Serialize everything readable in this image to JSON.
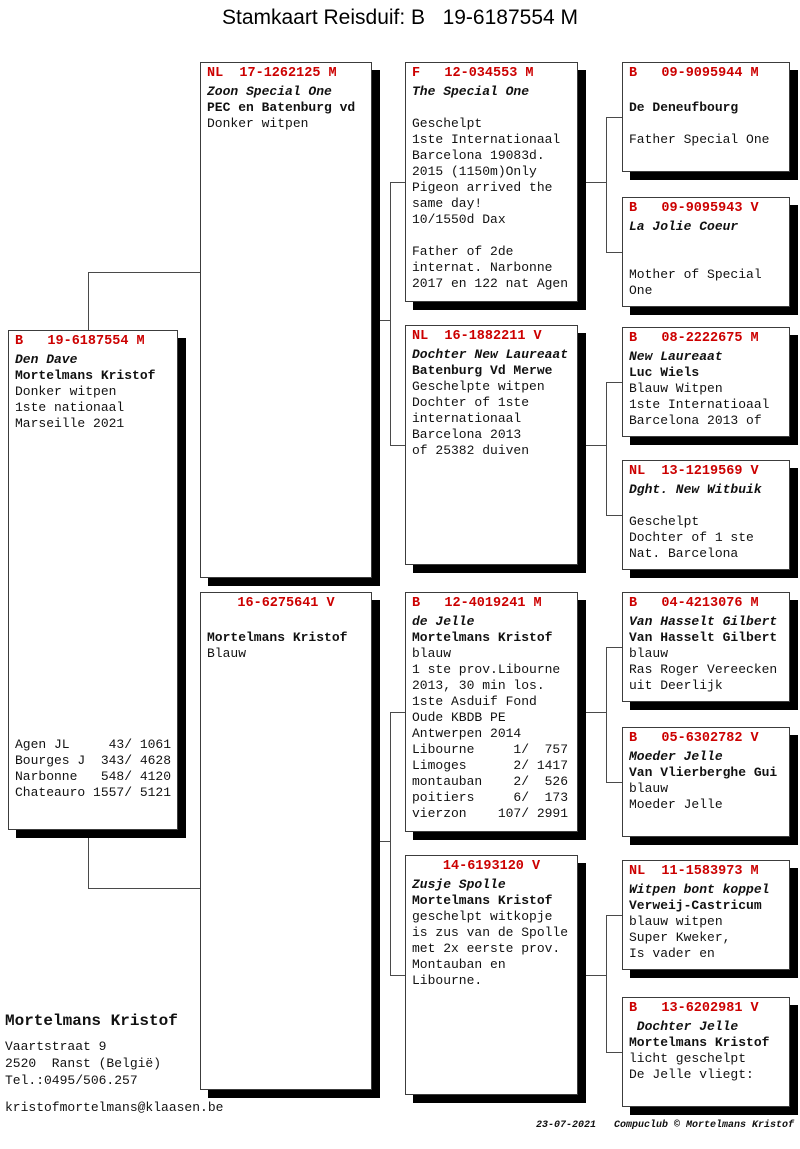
{
  "title": "Stamkaart Reisduif: B   19-6187554 M",
  "colors": {
    "header_red": "#cc0000",
    "shadow": "#000000"
  },
  "boxes": {
    "subject": {
      "header": "B   19-6187554 M",
      "lines": [
        "Den Dave",
        "Mortelmans Kristof",
        "Donker witpen",
        "1ste nationaal",
        "Marseille 2021"
      ],
      "results": [
        "Agen JL     43/ 1061",
        "Bourges J  343/ 4628",
        "Narbonne   548/ 4120",
        "Chateauro 1557/ 5121"
      ]
    },
    "sire": {
      "header": "NL  17-1262125 M",
      "lines": [
        "Zoon Special One",
        "PEC en Batenburg vd",
        "Donker witpen"
      ]
    },
    "dam": {
      "header": "16-6275641 V",
      "lines": [
        "",
        "Mortelmans Kristof",
        "Blauw"
      ]
    },
    "sire_sire": {
      "header": "F   12-034553 M",
      "lines": [
        "The Special One",
        "",
        "Geschelpt",
        "1ste Internationaal",
        "Barcelona 19083d.",
        "2015 (1150m)Only",
        "Pigeon arrived the",
        "same day!",
        "10/1550d Dax",
        "",
        "Father of 2de",
        "internat. Narbonne",
        "2017 en 122 nat Agen"
      ]
    },
    "sire_dam": {
      "header": "NL  16-1882211 V",
      "lines": [
        "Dochter New Laureaat",
        "Batenburg Vd Merwe",
        "Geschelpte witpen",
        "Dochter of 1ste",
        "internationaal",
        "Barcelona 2013",
        "of 25382 duiven"
      ]
    },
    "dam_sire": {
      "header": "B   12-4019241 M",
      "lines": [
        "de Jelle",
        "Mortelmans Kristof",
        "blauw",
        "1 ste prov.Libourne",
        "2013, 30 min los.",
        "1ste Asduif Fond",
        "Oude KBDB PE",
        "Antwerpen 2014",
        "Libourne     1/  757",
        "Limoges      2/ 1417",
        "montauban    2/  526",
        "poitiers     6/  173",
        "vierzon    107/ 2991"
      ]
    },
    "dam_dam": {
      "header": "14-6193120 V",
      "lines": [
        "Zusje Spolle",
        "Mortelmans Kristof",
        "geschelpt witkopje",
        "is zus van de Spolle",
        "met 2x eerste prov.",
        "Montauban en",
        "Libourne."
      ]
    },
    "gg1": {
      "header": "B   09-9095944 M",
      "lines": [
        "",
        "De Deneufbourg",
        "",
        "Father Special One"
      ]
    },
    "gg2": {
      "header": "B   09-9095943 V",
      "lines": [
        "La Jolie Coeur",
        "",
        "",
        "Mother of Special",
        "One"
      ]
    },
    "gg3": {
      "header": "B   08-2222675 M",
      "lines": [
        "New Laureaat",
        "Luc Wiels",
        "Blauw Witpen",
        "1ste Internatioaal",
        "Barcelona 2013 of"
      ]
    },
    "gg4": {
      "header": "NL  13-1219569 V",
      "lines": [
        "Dght. New Witbuik",
        "",
        "Geschelpt",
        "Dochter of 1 ste",
        "Nat. Barcelona"
      ]
    },
    "gg5": {
      "header": "B   04-4213076 M",
      "lines": [
        "Van Hasselt Gilbert",
        "Van Hasselt Gilbert",
        "blauw",
        "Ras Roger Vereecken",
        "uit Deerlijk"
      ]
    },
    "gg6": {
      "header": "B   05-6302782 V",
      "lines": [
        "Moeder Jelle",
        "Van Vlierberghe Gui",
        "blauw",
        "Moeder Jelle"
      ]
    },
    "gg7": {
      "header": "NL  11-1583973 M",
      "lines": [
        "Witpen bont koppel",
        "Verweij-Castricum",
        "blauw witpen",
        "Super Kweker,",
        "Is vader en"
      ]
    },
    "gg8": {
      "header": "B   13-6202981 V",
      "lines": [
        " Dochter Jelle",
        "Mortelmans Kristof",
        "licht geschelpt",
        "De Jelle vliegt:"
      ]
    }
  },
  "owner": {
    "name": "Mortelmans Kristof",
    "address_line1": "Vaartstraat 9",
    "address_line2": "2520  Ranst (België)",
    "phone": "Tel.:0495/506.257",
    "email": "kristofmortelmans@klaasen.be"
  },
  "footer": {
    "date": "23-07-2021",
    "credit": "Compuclub © Mortelmans Kristof"
  }
}
